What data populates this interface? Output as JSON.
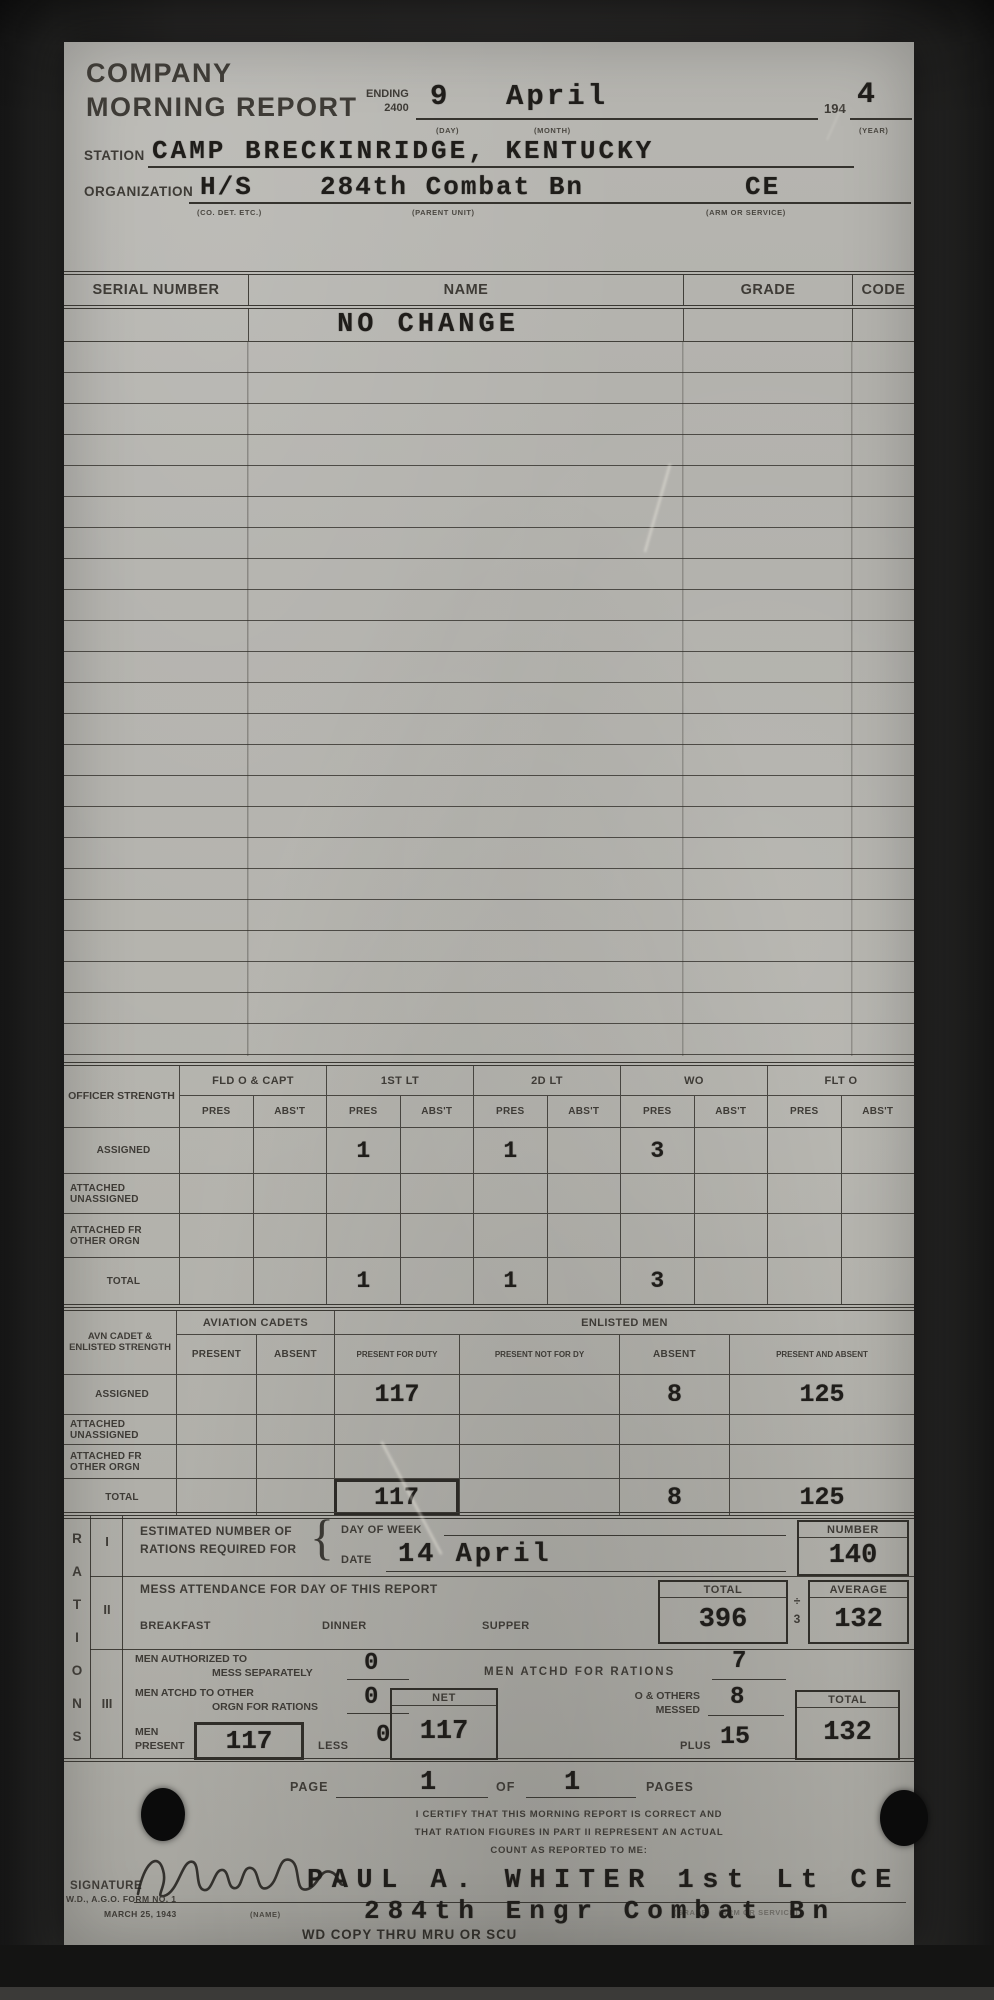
{
  "header": {
    "title_line1": "COMPANY",
    "title_line2": "MORNING REPORT",
    "ending_label": "ENDING",
    "ending_time": "2400",
    "day_value": "9",
    "month_value": "April",
    "day_caption": "(DAY)",
    "month_caption": "(MONTH)",
    "year_prefix": "194",
    "year_value": "4",
    "year_caption": "(YEAR)"
  },
  "station": {
    "label": "STATION",
    "value": "CAMP BRECKINRIDGE, KENTUCKY"
  },
  "organization": {
    "label": "ORGANIZATION",
    "unit": "H/S",
    "parent_unit": "284th Combat Bn",
    "arm": "CE",
    "unit_caption": "(CO. DET. ETC.)",
    "parent_caption": "(PARENT UNIT)",
    "arm_caption": "(ARM OR SERVICE)"
  },
  "roster": {
    "headers": [
      "SERIAL NUMBER",
      "NAME",
      "GRADE",
      "CODE"
    ],
    "first_entry": "NO CHANGE",
    "empty_row_count": 23
  },
  "officer_strength": {
    "corner_label": "OFFICER STRENGTH",
    "groups": [
      "FLD O & CAPT",
      "1ST LT",
      "2D LT",
      "WO",
      "FLT O"
    ],
    "subheaders": [
      "PRES",
      "ABS'T"
    ],
    "rows": [
      {
        "label": "ASSIGNED",
        "values": [
          "",
          "",
          "1",
          "",
          "1",
          "",
          "3",
          "",
          "",
          ""
        ]
      },
      {
        "label": "ATTACHED UNASSIGNED",
        "values": [
          "",
          "",
          "",
          "",
          "",
          "",
          "",
          "",
          "",
          ""
        ]
      },
      {
        "label": "ATTACHED FR OTHER ORGN",
        "values": [
          "",
          "",
          "",
          "",
          "",
          "",
          "",
          "",
          "",
          ""
        ]
      },
      {
        "label": "TOTAL",
        "values": [
          "",
          "",
          "1",
          "",
          "1",
          "",
          "3",
          "",
          "",
          ""
        ]
      }
    ]
  },
  "cadet_enlisted": {
    "corner_label": "AVN CADET & ENLISTED STRENGTH",
    "cadets_group": "AVIATION CADETS",
    "enlisted_group": "ENLISTED MEN",
    "subheaders": [
      "PRESENT",
      "ABSENT",
      "PRESENT FOR DUTY",
      "PRESENT NOT FOR DY",
      "ABSENT",
      "PRESENT AND ABSENT"
    ],
    "rows": [
      {
        "label": "ASSIGNED",
        "values": [
          "",
          "",
          "117",
          "",
          "8",
          "125"
        ],
        "boxed": []
      },
      {
        "label": "ATTACHED UNASSIGNED",
        "values": [
          "",
          "",
          "",
          "",
          "",
          ""
        ],
        "boxed": []
      },
      {
        "label": "ATTACHED FR OTHER ORGN",
        "values": [
          "",
          "",
          "",
          "",
          "",
          ""
        ],
        "boxed": []
      },
      {
        "label": "TOTAL",
        "values": [
          "",
          "",
          "117",
          "",
          "8",
          "125"
        ],
        "boxed": [
          2
        ]
      }
    ]
  },
  "rations": {
    "side_label": "RATIONS",
    "part1": {
      "numeral": "I",
      "label_line1": "ESTIMATED NUMBER OF",
      "label_line2": "RATIONS REQUIRED FOR",
      "brace_glyph": "{",
      "day_of_week_label": "DAY OF WEEK",
      "date_label": "DATE",
      "date_value": "14 April",
      "number_label": "NUMBER",
      "number_value": "140"
    },
    "part2": {
      "numeral": "II",
      "heading": "MESS ATTENDANCE FOR DAY OF THIS REPORT",
      "meal1": "BREAKFAST",
      "meal2": "DINNER",
      "meal3": "SUPPER",
      "total_label": "TOTAL",
      "total_value": "396",
      "divide_symbol": "÷",
      "divide_by": "3",
      "average_label": "AVERAGE",
      "average_value": "132"
    },
    "part3": {
      "numeral": "III",
      "auth_line1": "MEN AUTHORIZED TO",
      "auth_line2": "MESS SEPARATELY",
      "auth_value": "0",
      "atchd_rations_label": "MEN ATCHD FOR RATIONS",
      "atchd_rations_value": "7",
      "atchd_other_line1": "MEN ATCHD TO OTHER",
      "atchd_other_line2": "ORGN FOR RATIONS",
      "atchd_other_value": "0",
      "net_label": "NET",
      "net_value": "117",
      "others_line1": "O & OTHERS",
      "others_line2": "MESSED",
      "others_value": "8",
      "men_line1": "MEN",
      "men_line2": "PRESENT",
      "men_present_value": "117",
      "less_label": "LESS",
      "less_value": "0",
      "plus_label": "PLUS",
      "plus_value": "15",
      "total_label": "TOTAL",
      "total_value": "132"
    }
  },
  "footer": {
    "page_label": "PAGE",
    "page_value": "1",
    "of_label": "OF",
    "pages_value": "1",
    "pages_label": "PAGES",
    "cert_line1": "I CERTIFY THAT THIS MORNING REPORT IS CORRECT AND",
    "cert_line2": "THAT RATION FIGURES IN PART II REPRESENT AN ACTUAL",
    "cert_line3": "COUNT AS REPORTED TO ME:",
    "signature_label": "SIGNATURE",
    "name_caption": "(NAME)",
    "signer_name": "PAUL A. WHITER 1st Lt CE",
    "signer_unit": "284th Engr Combat Bn",
    "grade_caption": "(GRADE)   (ARM OR SERVICE)",
    "stamp": "WD COPY THRU MRU OR SCU",
    "form_number": "W.D., A.G.O. FORM NO. 1",
    "form_date": "MARCH 25, 1943"
  }
}
